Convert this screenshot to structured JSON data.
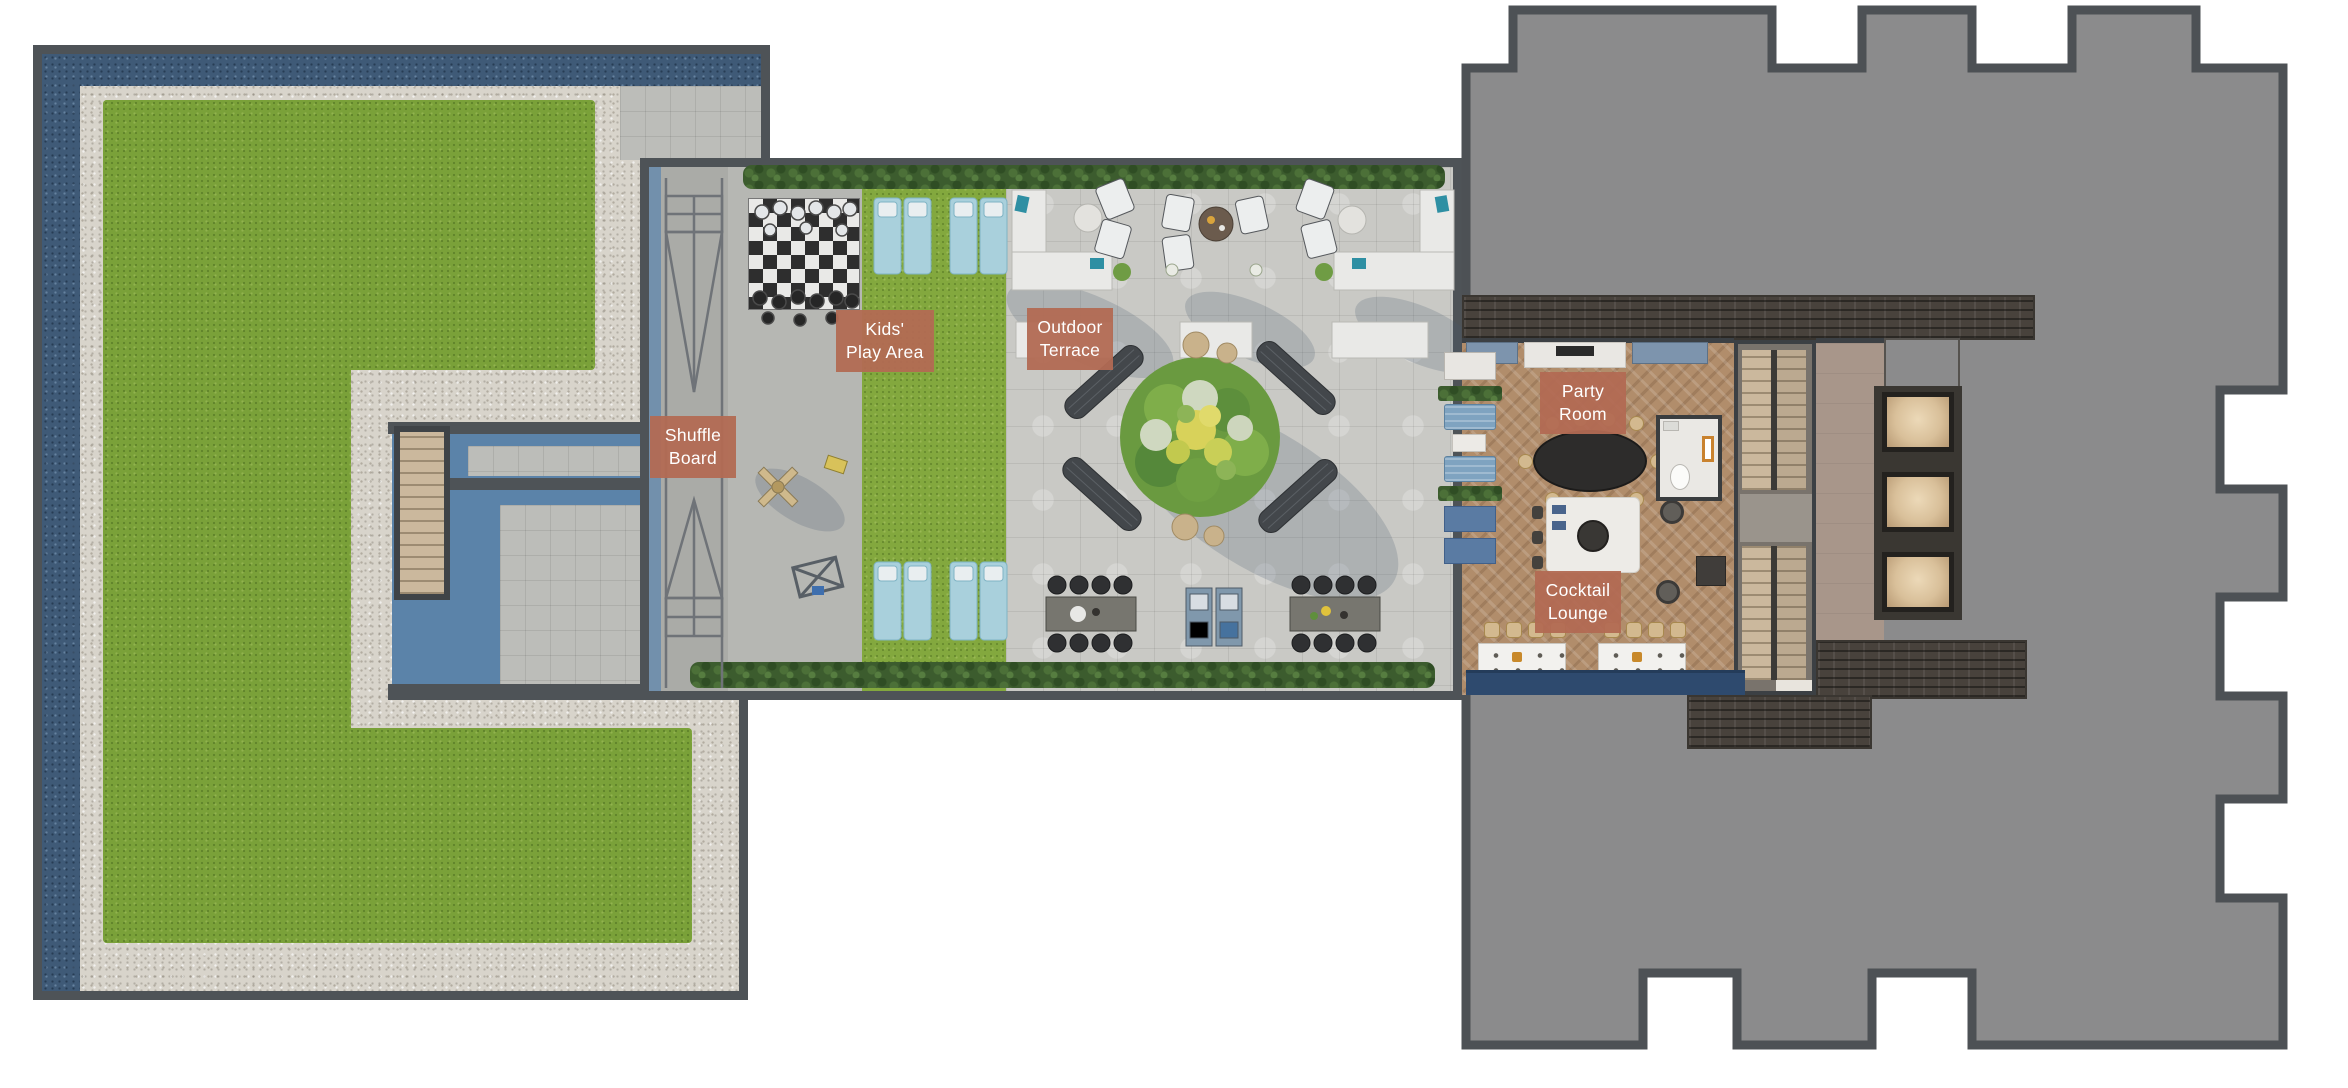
{
  "labels": {
    "shuffle_board": "Shuffle\nBoard",
    "kids_play_area": "Kids'\nPlay Area",
    "outdoor_terrace": "Outdoor\nTerrace",
    "party_room": "Party\nRoom",
    "cocktail_lounge": "Cocktail\nLounge"
  },
  "colors": {
    "label_background": "#b26a53",
    "label_text": "#ffffff",
    "roof_gray": "#8b8b8c",
    "wall_dark": "#4e5357",
    "lawn_green": "#7aa139",
    "gravel": "#d8d4cb",
    "perimeter_bluestone": "#3f5a77",
    "terrace_paver": "#c9c9c5",
    "wood_floor": "#b18d6b",
    "banquette_blue": "#2e4a6e",
    "courtyard_shadow_blue": "#5b83a9",
    "hedge_green": "#3c5c2e"
  }
}
